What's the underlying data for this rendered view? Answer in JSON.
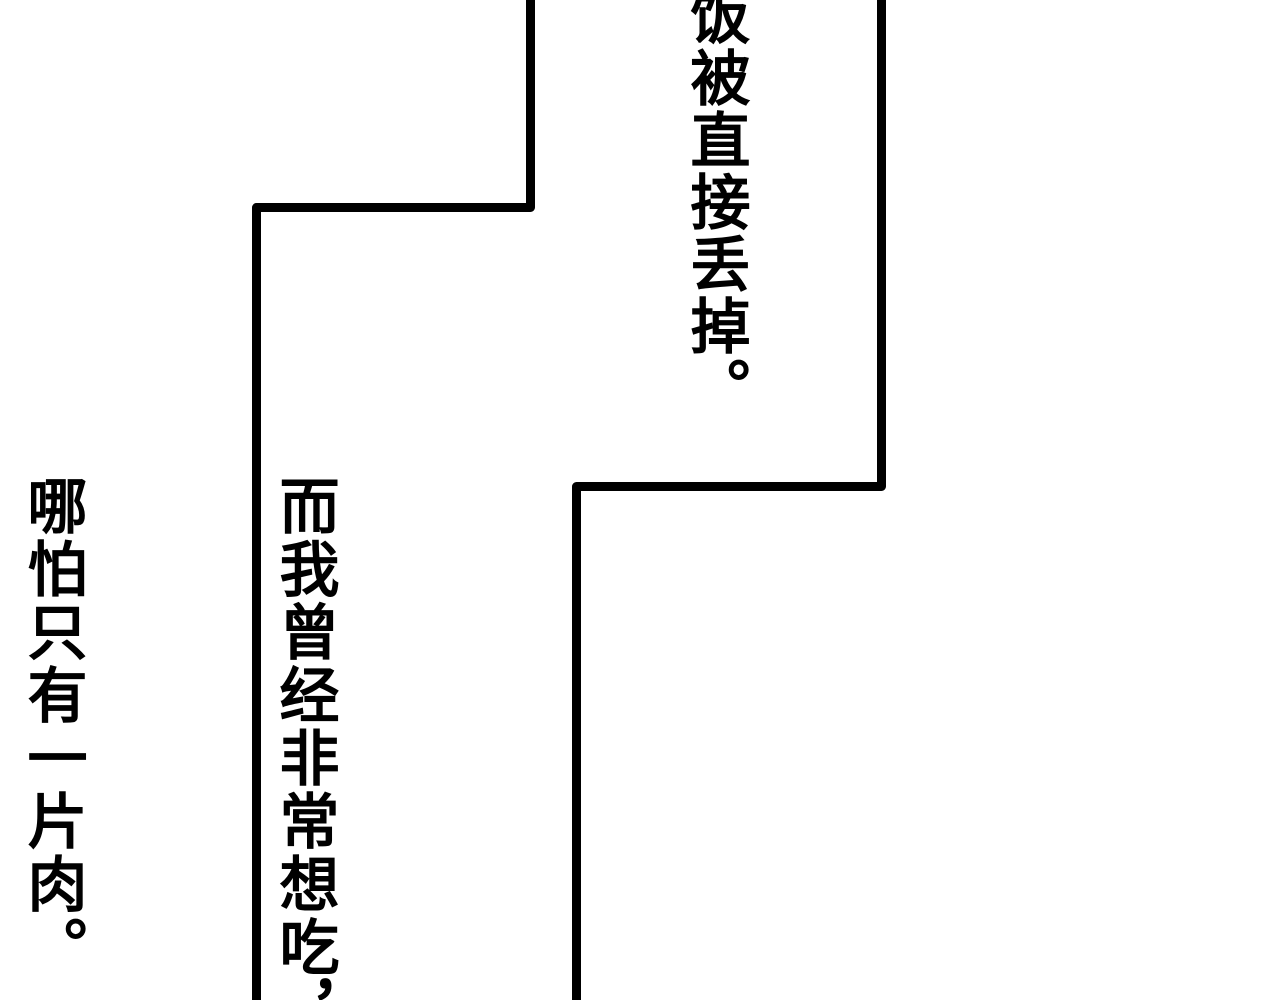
{
  "page": {
    "type": "comic-strip-segment",
    "colors": {
      "background": "#ffffff",
      "ink": "#000000"
    }
  },
  "panels": {
    "top": {
      "dialogue": "饭被直接丢掉。"
    },
    "bottom": {
      "dialogue_lines": {
        "0": "而我曾经非常想吃，",
        "1": "哪怕只有一片肉。"
      }
    }
  }
}
